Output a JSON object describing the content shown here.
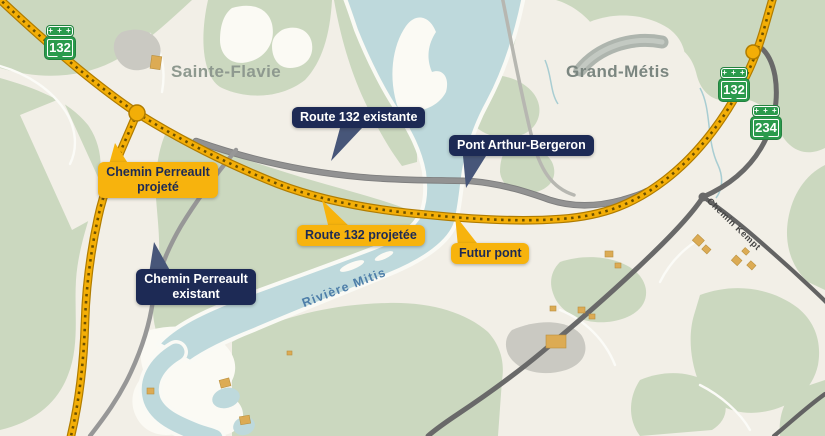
{
  "places": {
    "sainte_flavie": "Sainte-Flavie",
    "grand_metis": "Grand-Métis"
  },
  "water_labels": {
    "riviere_mitis": "Rivière Mitis"
  },
  "road_labels": {
    "chemin_kempt": "Chemin Kempt"
  },
  "shields": {
    "left_132": {
      "number": "132",
      "crest": "+ + +"
    },
    "right_132": {
      "number": "132",
      "crest": "+ + +"
    },
    "right_234": {
      "number": "234",
      "crest": "+ + +"
    }
  },
  "callouts": {
    "route_132_existante": {
      "label": "Route 132 existante",
      "style": "existing-navy"
    },
    "pont_arthur_bergeron": {
      "label": "Pont Arthur-Bergeron",
      "style": "existing-navy"
    },
    "chemin_perreault_existant": {
      "label": "Chemin Perreault existant",
      "style": "existing-navy"
    },
    "chemin_perreault_projete": {
      "label": "Chemin Perreault projeté",
      "style": "projected-yellow"
    },
    "route_132_projetee": {
      "label": "Route 132 projetée",
      "style": "projected-yellow"
    },
    "futur_pont": {
      "label": "Futur pont",
      "style": "projected-yellow"
    }
  },
  "colors": {
    "navy_label": "#1d2a55",
    "yellow_label": "#f7b30d",
    "projected_road": "#f3ae07",
    "existing_road": "#8c8c8c",
    "shield_green": "#2a9a4c",
    "water": "#bed9dc",
    "land_green": "#cbd8bf",
    "land_cream": "#f2efe7",
    "river_label_blue": "#4d7ea9"
  }
}
